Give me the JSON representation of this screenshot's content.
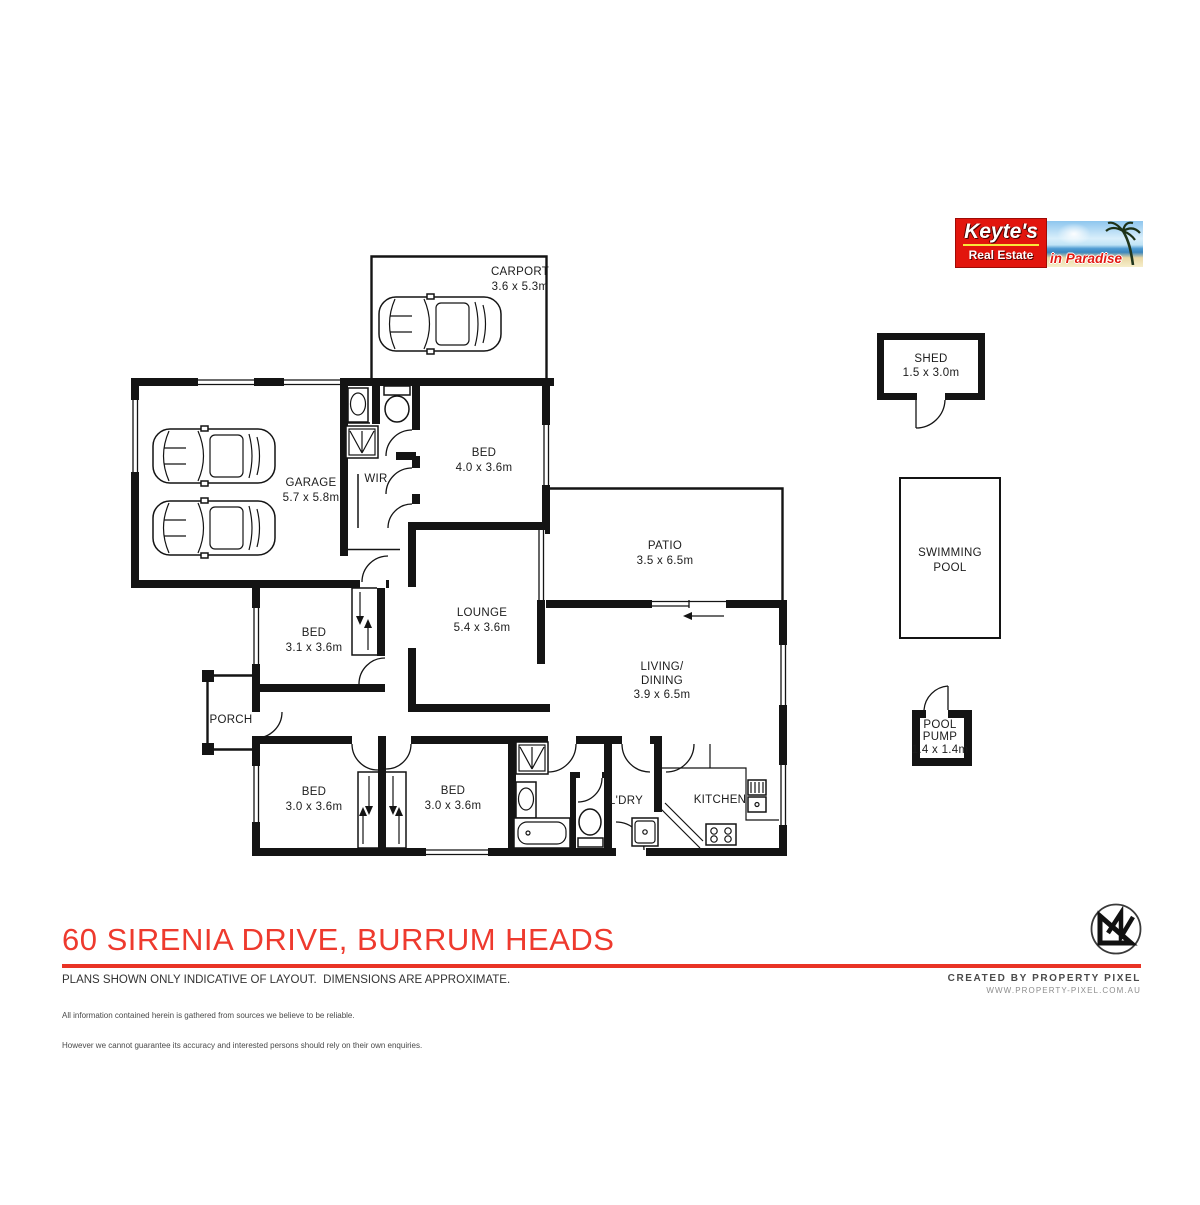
{
  "logo": {
    "brand": "Keyte's",
    "subtitle": "Real Estate",
    "tagline": "in Paradise",
    "brand_red": "#e2150d",
    "underline_yellow": "#f8e73b"
  },
  "plan": {
    "rooms": {
      "carport": {
        "name": "CARPORT",
        "dims": "3.6 x 5.3m"
      },
      "garage": {
        "name": "GARAGE",
        "dims": "5.7 x 5.8m"
      },
      "wir": {
        "name": "WIR"
      },
      "bed_master": {
        "name": "BED",
        "dims": "4.0 x 3.6m"
      },
      "patio": {
        "name": "PATIO",
        "dims": "3.5 x 6.5m"
      },
      "lounge": {
        "name": "LOUNGE",
        "dims": "5.4 x 3.6m"
      },
      "living": {
        "name1": "LIVING/",
        "name2": "DINING",
        "dims": "3.9 x 6.5m"
      },
      "bed2": {
        "name": "BED",
        "dims": "3.1 x 3.6m"
      },
      "porch": {
        "name": "PORCH"
      },
      "bed3": {
        "name": "BED",
        "dims": "3.0 x 3.6m"
      },
      "bed4": {
        "name": "BED",
        "dims": "3.0 x 3.6m"
      },
      "laundry": {
        "name": "L'DRY"
      },
      "kitchen": {
        "name": "KITCHEN"
      },
      "shed": {
        "name": "SHED",
        "dims": "1.5 x 3.0m"
      },
      "pool": {
        "name1": "SWIMMING",
        "name2": "POOL"
      },
      "pump": {
        "name1": "POOL",
        "name2": "PUMP",
        "dims": "1.4 x 1.4m"
      }
    }
  },
  "footer": {
    "address": "60 SIRENIA DRIVE, BURRUM HEADS",
    "accent_red": "#e93325",
    "disclaimer_main": "PLANS SHOWN ONLY INDICATIVE OF LAYOUT.  DIMENSIONS ARE APPROXIMATE.",
    "disclaimer_line1": "All information contained herein is gathered from sources we believe to be reliable.",
    "disclaimer_line2": "However we cannot guarantee its accuracy and interested persons should rely on their own enquiries.",
    "credit_line1": "CREATED BY PROPERTY PIXEL",
    "credit_line2": "WWW.PROPERTY-PIXEL.COM.AU"
  }
}
